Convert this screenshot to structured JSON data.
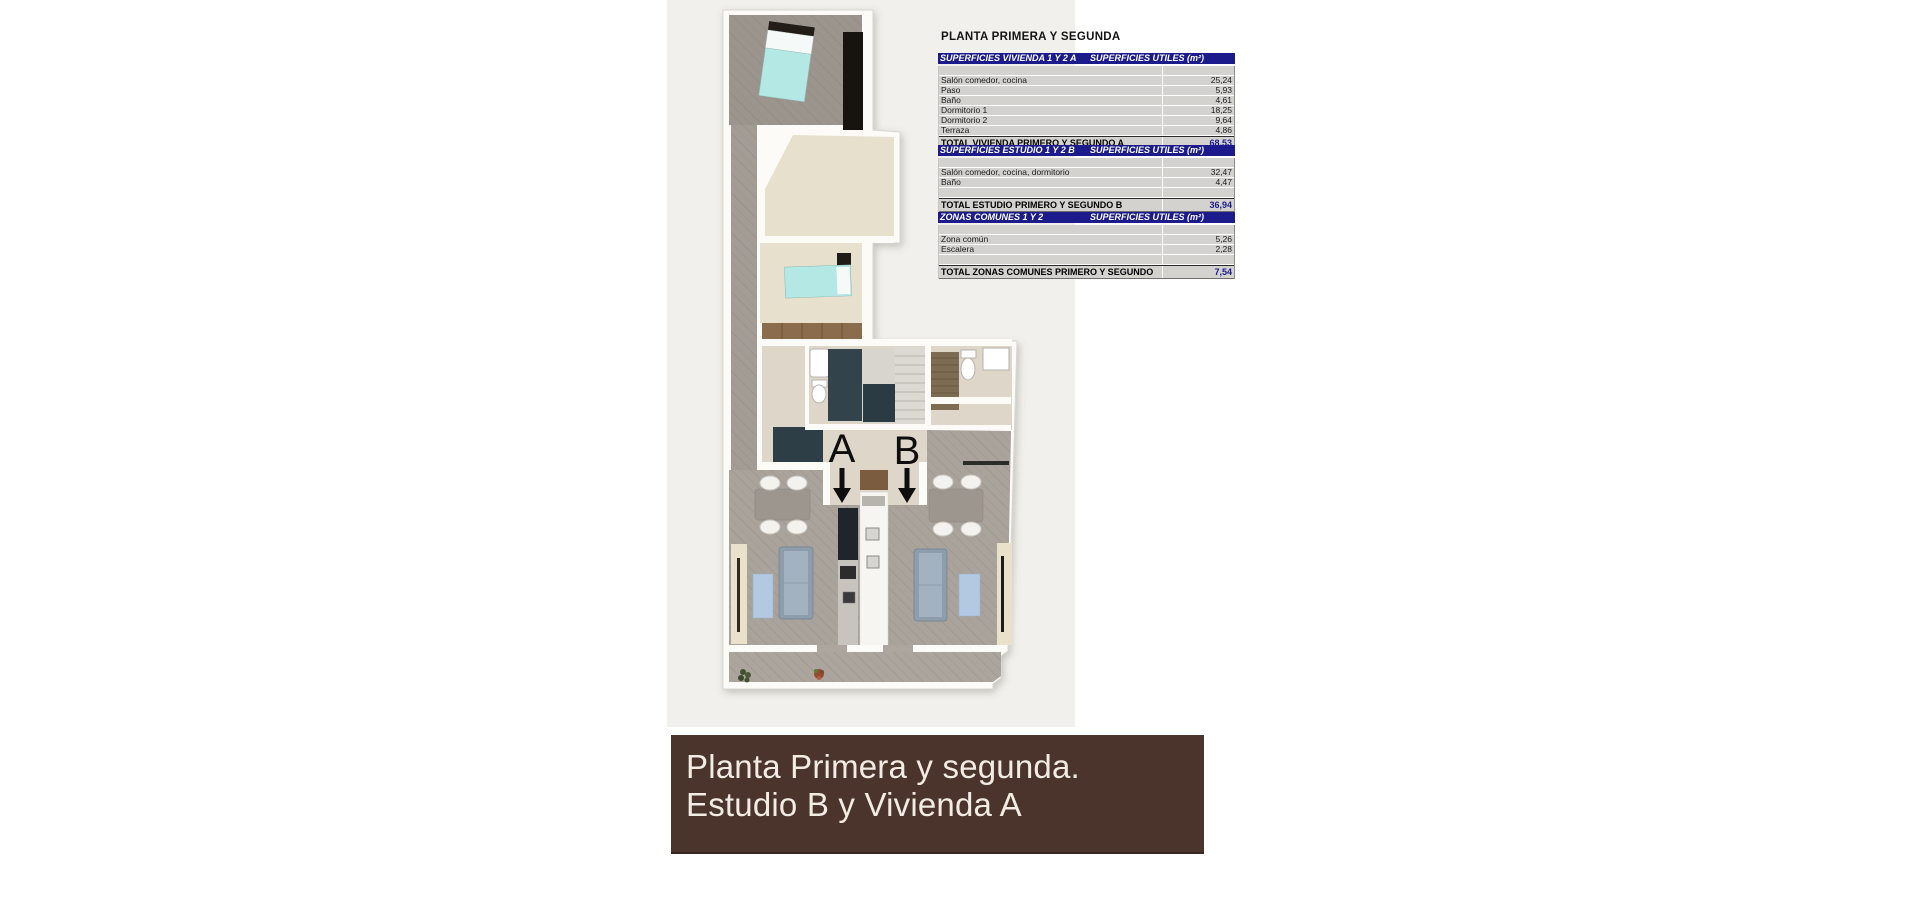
{
  "page": {
    "title": "PLANTA PRIMERA Y SEGUNDA"
  },
  "tables": [
    {
      "header_left": "SUPERFICIES VIVIENDA 1 Y 2 A",
      "header_right": "SUPERFICIES UTILES  (m²)",
      "rows": [
        {
          "label": "Salón comedor, cocina",
          "value": "25,24"
        },
        {
          "label": "Paso",
          "value": "5,93"
        },
        {
          "label": "Baño",
          "value": "4,61"
        },
        {
          "label": "Dormitorio 1",
          "value": "18,25"
        },
        {
          "label": "Dormitorio 2",
          "value": "9,64"
        },
        {
          "label": "Terraza",
          "value": "4,86"
        }
      ],
      "gap_before_total": false,
      "total_label": "TOTAL VIVIENDA PRIMERO Y SEGUNDO A",
      "total_value": "68,53"
    },
    {
      "header_left": "SUPERFICIES ESTUDIO 1 Y 2 B",
      "header_right": "SUPERFICIES UTILES  (m²)",
      "rows": [
        {
          "label": "Salón comedor, cocina, dormitorio",
          "value": "32,47"
        },
        {
          "label": "Baño",
          "value": "4,47"
        }
      ],
      "gap_before_total": true,
      "total_label": "TOTAL ESTUDIO PRIMERO Y SEGUNDO B",
      "total_value": "36,94"
    },
    {
      "header_left": "ZONAS COMUNES 1 Y 2",
      "header_right": "SUPERFICIES UTILES  (m²)",
      "rows": [
        {
          "label": "Zona común",
          "value": "5,26"
        },
        {
          "label": "Escalera",
          "value": "2,28"
        }
      ],
      "gap_before_total": true,
      "total_label": "TOTAL ZONAS COMUNES PRIMERO Y SEGUNDO",
      "total_value": "7,54"
    }
  ],
  "floorplan": {
    "unit_a_label": "A",
    "unit_b_label": "B"
  },
  "banner": {
    "line1": "Planta Primera y segunda.",
    "line2": "Estudio B y Vivienda A"
  },
  "colors": {
    "table_header_bg": "#1b1b8c",
    "table_row_bg": "#d3d2cf",
    "total_value_color": "#1b1b8c",
    "banner_bg": "#4a342c",
    "banner_text": "#f2ece5",
    "photo_bg": "#f1f0ec",
    "plan_accent_cyan": "#b4e8e4",
    "plan_dark_slate": "#33434c"
  }
}
